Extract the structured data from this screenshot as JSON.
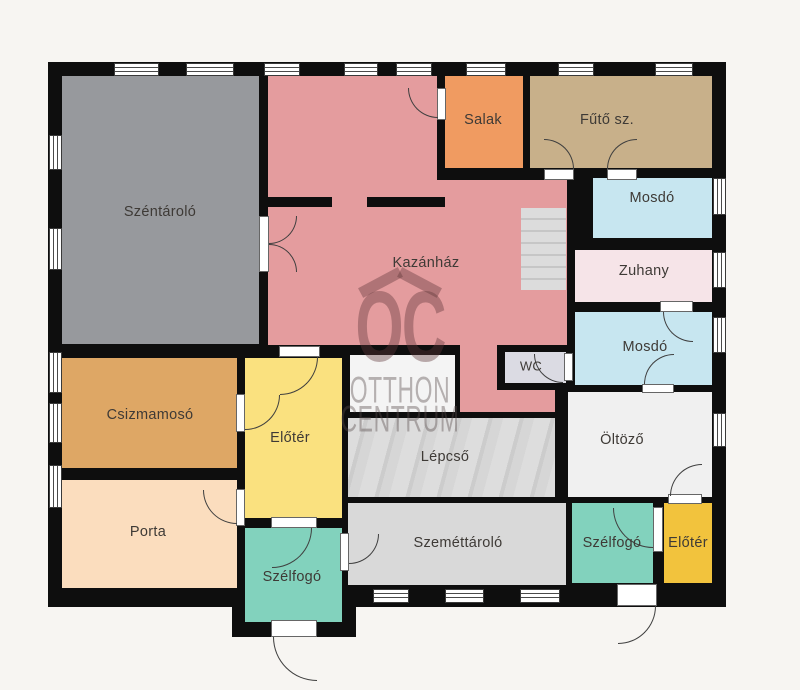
{
  "plan": {
    "background": "#F7F5F2",
    "wall_color": "#0E0E0E",
    "watermark": {
      "logo": "OC",
      "line1": "OTTHON",
      "line2": "CENTRUM"
    },
    "footprint": [
      [
        48,
        62,
        678,
        545
      ],
      [
        232,
        590,
        124,
        47
      ]
    ],
    "rooms": [
      {
        "id": "szentarolo",
        "label": "Széntároló",
        "color": "#97999D",
        "rects": [
          [
            62,
            76,
            197,
            268
          ]
        ],
        "label_pos": [
          160,
          212
        ]
      },
      {
        "id": "kazanhaz",
        "label": "Kazánház",
        "color": "#E49C9E",
        "rects": [
          [
            268,
            76,
            169,
            140
          ],
          [
            268,
            180,
            299,
            165
          ],
          [
            460,
            345,
            37,
            67
          ],
          [
            460,
            390,
            95,
            22
          ]
        ],
        "label_pos": [
          426,
          263
        ]
      },
      {
        "id": "salak",
        "label": "Salak",
        "color": "#F09B61",
        "rects": [
          [
            445,
            76,
            78,
            92
          ]
        ],
        "label_pos": [
          483,
          120
        ]
      },
      {
        "id": "futo-szoba",
        "label": "Fűtő sz.",
        "color": "#C8B08A",
        "rects": [
          [
            530,
            76,
            182,
            92
          ]
        ],
        "label_pos": [
          607,
          120
        ]
      },
      {
        "id": "mosdo-1",
        "label": "Mosdó",
        "color": "#C7E6F0",
        "rects": [
          [
            593,
            178,
            119,
            60
          ]
        ],
        "label_pos": [
          652,
          198
        ]
      },
      {
        "id": "zuhany",
        "label": "Zuhany",
        "color": "#F6E4E8",
        "rects": [
          [
            575,
            250,
            137,
            52
          ]
        ],
        "label_pos": [
          644,
          271
        ]
      },
      {
        "id": "mosdo-2",
        "label": "Mosdó",
        "color": "#C7E6F0",
        "rects": [
          [
            575,
            312,
            137,
            73
          ]
        ],
        "label_pos": [
          645,
          347
        ]
      },
      {
        "id": "wc",
        "label": "WC",
        "color": "#DBDBE3",
        "rects": [
          [
            505,
            352,
            61,
            31
          ]
        ],
        "label_pos": [
          531,
          366
        ],
        "label_size": 13
      },
      {
        "id": "oltozo",
        "label": "Öltöző",
        "color": "#F0F0F0",
        "rects": [
          [
            568,
            392,
            144,
            105
          ]
        ],
        "label_pos": [
          622,
          440
        ]
      },
      {
        "id": "raktar",
        "label": null,
        "color": "#F4F4F4",
        "rects": [
          [
            350,
            355,
            105,
            57
          ]
        ],
        "label_pos": null
      },
      {
        "id": "lepcso",
        "label": "Lépcső",
        "color": "#D6D6D6",
        "texture": "stairs-diagonal",
        "rects": [
          [
            348,
            418,
            207,
            79
          ]
        ],
        "label_pos": [
          445,
          457
        ]
      },
      {
        "id": "szemettarolo",
        "label": "Szeméttároló",
        "color": "#D9D9D9",
        "rects": [
          [
            348,
            503,
            218,
            82
          ]
        ],
        "label_pos": [
          458,
          543
        ]
      },
      {
        "id": "szelfogo-jobb",
        "label": "Szélfogó",
        "color": "#82D2BD",
        "rects": [
          [
            572,
            503,
            81,
            80
          ]
        ],
        "label_pos": [
          612,
          543
        ]
      },
      {
        "id": "eloter-jobb",
        "label": "Előtér",
        "color": "#F2C33D",
        "rects": [
          [
            664,
            503,
            48,
            80
          ]
        ],
        "label_pos": [
          688,
          543
        ]
      },
      {
        "id": "csizmamoso",
        "label": "Csizmamosó",
        "color": "#DEA765",
        "rects": [
          [
            62,
            358,
            175,
            110
          ]
        ],
        "label_pos": [
          150,
          415
        ]
      },
      {
        "id": "eloter-kozep",
        "label": "Előtér",
        "color": "#FAE17F",
        "rects": [
          [
            245,
            358,
            97,
            160
          ]
        ],
        "label_pos": [
          290,
          438
        ]
      },
      {
        "id": "porta",
        "label": "Porta",
        "color": "#FBDDBE",
        "rects": [
          [
            62,
            480,
            175,
            108
          ]
        ],
        "label_pos": [
          148,
          532
        ]
      },
      {
        "id": "szelfogo-bal",
        "label": "Szélfogó",
        "color": "#82D2BD",
        "rects": [
          [
            245,
            528,
            97,
            94
          ]
        ],
        "label_pos": [
          292,
          577
        ]
      }
    ],
    "partial_walls": [
      [
        268,
        197,
        64,
        10
      ],
      [
        367,
        197,
        78,
        10
      ]
    ],
    "stairs_small": [
      521,
      208,
      45,
      82
    ],
    "windows": [
      [
        114,
        63,
        45,
        13
      ],
      [
        186,
        63,
        48,
        13
      ],
      [
        264,
        63,
        36,
        13
      ],
      [
        344,
        63,
        34,
        13
      ],
      [
        396,
        63,
        36,
        13
      ],
      [
        466,
        63,
        40,
        13
      ],
      [
        558,
        63,
        36,
        13
      ],
      [
        655,
        63,
        38,
        13
      ],
      [
        49,
        135,
        13,
        35
      ],
      [
        49,
        228,
        13,
        42
      ],
      [
        49,
        352,
        13,
        41
      ],
      [
        49,
        403,
        13,
        40
      ],
      [
        49,
        465,
        13,
        43
      ],
      [
        713,
        178,
        13,
        37
      ],
      [
        713,
        252,
        13,
        36
      ],
      [
        713,
        317,
        13,
        36
      ],
      [
        713,
        413,
        13,
        34
      ],
      [
        373,
        589,
        36,
        14
      ],
      [
        445,
        589,
        39,
        14
      ],
      [
        520,
        589,
        40,
        14
      ]
    ],
    "doors": [
      {
        "name": "szentarolo-kazanhaz",
        "band": [
          259,
          216,
          10,
          56
        ],
        "arcs": [
          [
            269,
            216,
            28,
            "tl"
          ],
          [
            269,
            244,
            28,
            "bl"
          ]
        ]
      },
      {
        "name": "salak-kazanhaz",
        "band": [
          437,
          88,
          9,
          32
        ],
        "arcs": [
          [
            408,
            88,
            30,
            "tr"
          ]
        ]
      },
      {
        "name": "futo-bal",
        "band": [
          544,
          169,
          30,
          11
        ],
        "arcs": [
          [
            544,
            139,
            30,
            "bl"
          ]
        ]
      },
      {
        "name": "futo-jobb",
        "band": [
          607,
          169,
          30,
          11
        ],
        "arcs": [
          [
            607,
            139,
            30,
            "br"
          ]
        ]
      },
      {
        "name": "zuhany-mosdo",
        "band": [
          660,
          301,
          33,
          11
        ],
        "arcs": [
          [
            663,
            312,
            30,
            "tr"
          ]
        ]
      },
      {
        "name": "mosdo-oltozo",
        "band": [
          642,
          384,
          32,
          9
        ],
        "arcs": [
          [
            644,
            354,
            30,
            "br"
          ]
        ]
      },
      {
        "name": "wc-mosdo",
        "band": [
          564,
          353,
          9,
          28
        ],
        "arcs": [
          [
            534,
            354,
            29,
            "tr"
          ]
        ]
      },
      {
        "name": "oltozo-eloter",
        "band": [
          668,
          494,
          34,
          10
        ],
        "arcs": [
          [
            670,
            464,
            32,
            "br"
          ]
        ]
      },
      {
        "name": "szelfogo-eloter-jobb",
        "band": [
          653,
          507,
          10,
          45
        ],
        "arcs": [
          [
            613,
            508,
            40,
            "tr"
          ]
        ]
      },
      {
        "name": "szelfogo-jobb-kijarat",
        "band": [
          617,
          584,
          40,
          22
        ],
        "arcs": [
          [
            618,
            606,
            38,
            "tl"
          ]
        ]
      },
      {
        "name": "szelfogo-szemettarolo",
        "band": [
          340,
          533,
          9,
          38
        ],
        "arcs": [
          [
            349,
            534,
            30,
            "tl"
          ]
        ]
      },
      {
        "name": "eloter-szelfogo-bal",
        "band": [
          271,
          517,
          46,
          11
        ],
        "arcs": [
          [
            272,
            528,
            40,
            "tl"
          ]
        ]
      },
      {
        "name": "szelfogo-bal-kijarat",
        "band": [
          271,
          620,
          46,
          17
        ],
        "arcs": [
          [
            273,
            637,
            44,
            "tr"
          ]
        ]
      },
      {
        "name": "kazanhaz-eloter",
        "band": [
          279,
          346,
          41,
          11
        ],
        "arcs": [
          [
            280,
            357,
            38,
            "tl"
          ]
        ]
      },
      {
        "name": "csizmamoso-eloter",
        "band": [
          236,
          394,
          9,
          38
        ],
        "arcs": [
          [
            245,
            395,
            35,
            "tl"
          ]
        ]
      },
      {
        "name": "porta-eloter",
        "band": [
          236,
          489,
          9,
          37
        ],
        "arcs": [
          [
            203,
            490,
            34,
            "tr"
          ]
        ]
      }
    ]
  }
}
